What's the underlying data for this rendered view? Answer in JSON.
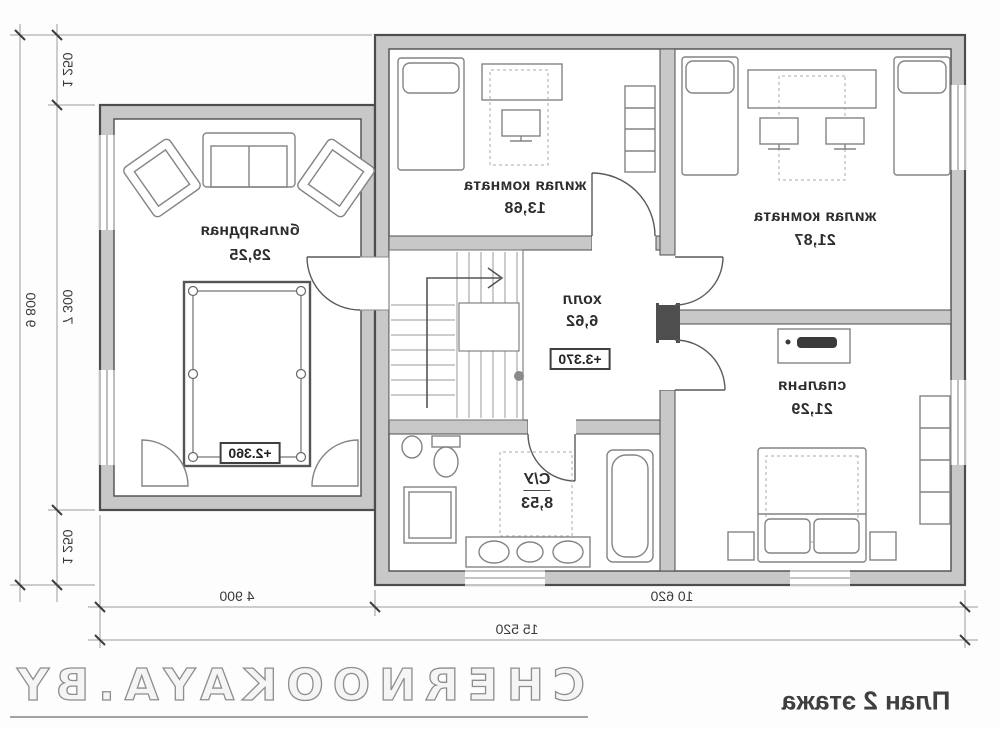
{
  "title": "План 2 этажа",
  "watermark": "CHERNOOKAYA.BY",
  "rooms": [
    {
      "name": "жилая комната",
      "area": "13,68"
    },
    {
      "name": "жилая комната",
      "area": "21,87"
    },
    {
      "name": "спальня",
      "area": "21,29"
    },
    {
      "name": "холл",
      "area": "6,62",
      "level": "+3.370"
    },
    {
      "name": "С/У",
      "area": "8,53"
    },
    {
      "name": "бильярдная",
      "area": "29,25",
      "level": "+2.360"
    }
  ],
  "dimensions": {
    "total_width": "15 520",
    "main_block_width": "10 620",
    "annex_width": "4 900",
    "total_height": "9 800",
    "height_segment_top": "1 250",
    "height_segment_middle": "7 300",
    "height_segment_bottom": "1 250"
  },
  "colors": {
    "wall_fill": "#c8c8c8",
    "wall_line": "#4d4d4d",
    "furniture_line": "#848484",
    "dim_line": "#9b9b9b",
    "text": "#2d2d2d",
    "watermark": "#8e8e8e"
  }
}
